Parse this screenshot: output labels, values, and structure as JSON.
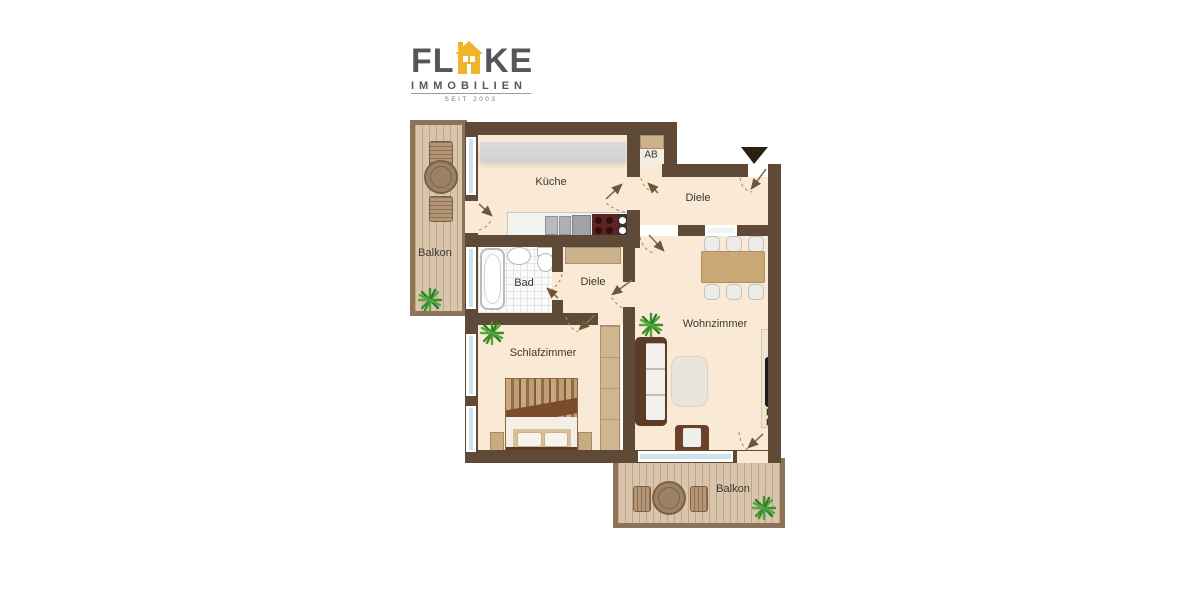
{
  "logo": {
    "brand_first": "FL",
    "brand_last": "KE",
    "subtitle": "IMMOBILIEN",
    "since": "SEIT 2003"
  },
  "rooms": {
    "kueche": "Küche",
    "ab": "AB",
    "diele_top": "Diele",
    "bad": "Bad",
    "diele_mid": "Diele",
    "wohnzimmer": "Wohnzimmer",
    "schlafzimmer": "Schlafzimmer",
    "balkon_left": "Balkon",
    "balkon_bottom": "Balkon"
  },
  "colors": {
    "wall": "#5e4a37",
    "balcony_wall": "#8d7357",
    "floor": "#f9e9d5",
    "wood": "#d9c5ab",
    "window_glass": "#cfe3ee",
    "logo_yellow": "#f0b429",
    "logo_gray": "#55565a",
    "plant_green": "#3f8f2f",
    "stove_red": "#5f2322",
    "table_tan": "#c9a876"
  }
}
